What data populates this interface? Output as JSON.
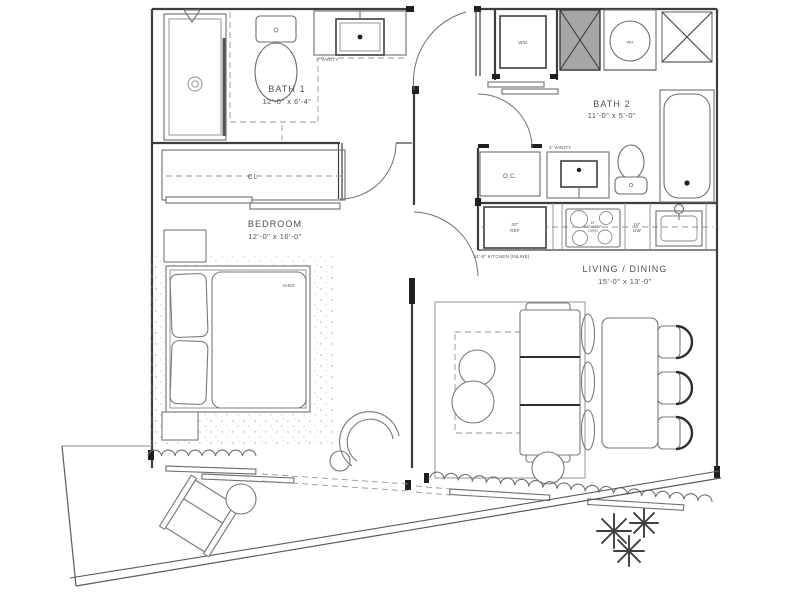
{
  "plan_type": "residential-unit-floor-plan",
  "rooms": {
    "bath1": {
      "name": "BATH 1",
      "dims": "12'-0\" x 6'-4\""
    },
    "bath2": {
      "name": "BATH 2",
      "dims": "11'-0\" x 5'-0\""
    },
    "bedroom": {
      "name": "BEDROOM",
      "dims": "12'-0\" x 16'-0\""
    },
    "living": {
      "name": "LIVING / DINING",
      "dims": "15'-0\" x 13'-0\""
    }
  },
  "labels": {
    "closet": "CL",
    "bed": "KING",
    "washer_dryer": "W/D",
    "water_heater": "WH",
    "owners_closet": "O.C.",
    "bath1_vanity": "4' VANITY",
    "bath2_vanity": "3' VANITY",
    "kitchen": "11'-6\" KITCHEN (INLINE)",
    "fridge_line1": "30\"",
    "fridge_line2": "REF",
    "cooktop_line1": "30\"",
    "cooktop_line2": "COOKTOP",
    "cooktop_line3": "OVEN",
    "dishwasher_line1": "18\"",
    "dishwasher_line2": "DW"
  },
  "colors": {
    "wall": "#3d3d3d",
    "fixture_line": "#6e6e6e",
    "light_line": "#8a8a8a",
    "shaft_fill": "#a6a6a6",
    "text": "#4f4f4f",
    "background": "#ffffff"
  }
}
